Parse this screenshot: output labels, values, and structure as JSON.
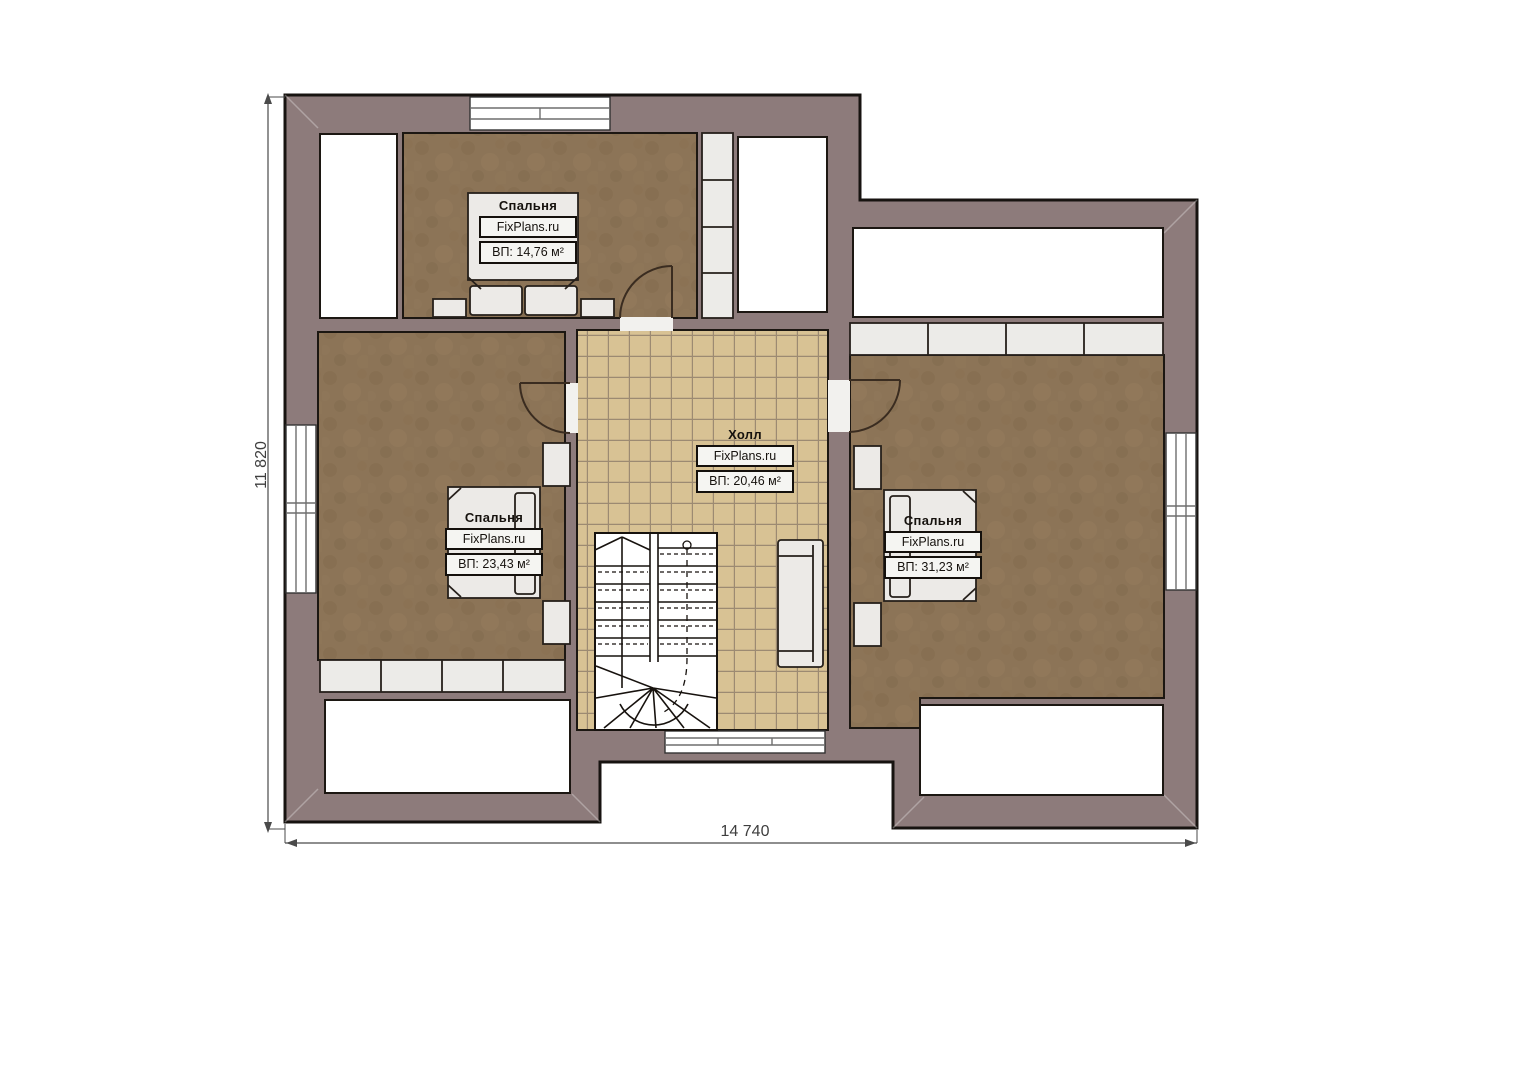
{
  "plan": {
    "rooms": [
      {
        "id": "bedroom-top",
        "name": "Спальня",
        "brand": "FixPlans.ru",
        "area": "ВП: 14,76 м²"
      },
      {
        "id": "bedroom-left",
        "name": "Спальня",
        "brand": "FixPlans.ru",
        "area": "ВП: 23,43 м²"
      },
      {
        "id": "hall",
        "name": "Холл",
        "brand": "FixPlans.ru",
        "area": "ВП: 20,46 м²"
      },
      {
        "id": "bedroom-right",
        "name": "Спальня",
        "brand": "FixPlans.ru",
        "area": "ВП: 31,23 м²"
      }
    ],
    "dimensions": {
      "width_mm": "14 740",
      "height_mm": "11 820"
    },
    "colors": {
      "wall": "#8d7b7b",
      "carpet": "#8c7457",
      "tile": "#d8c294",
      "outline": "#1c1712"
    }
  }
}
